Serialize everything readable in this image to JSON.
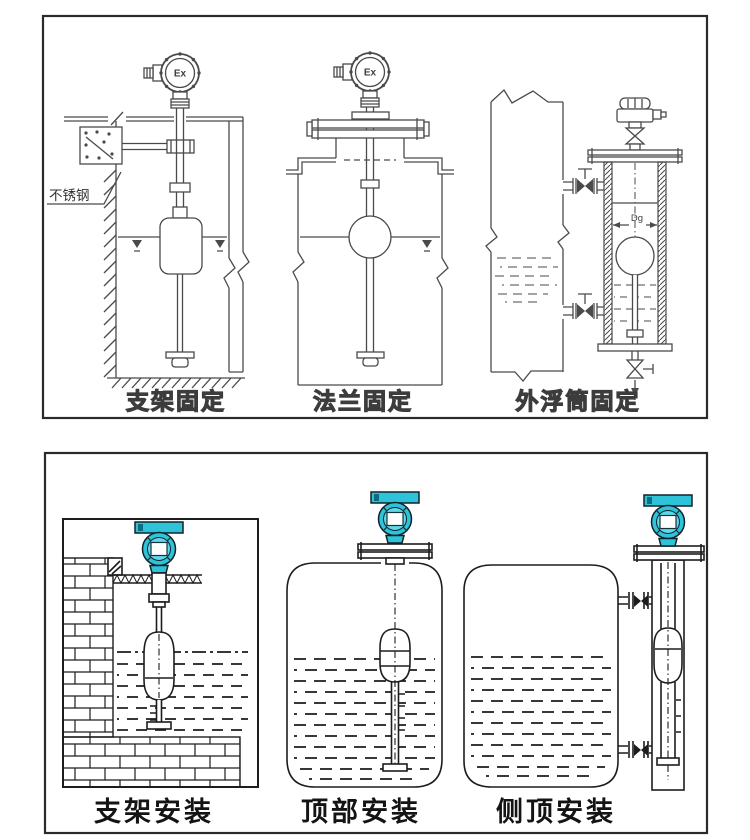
{
  "colors": {
    "background": "#ffffff",
    "panel_border": "#2a2a2a",
    "line": "#4a4a4a",
    "line_dark": "#1d1d1d",
    "teal": "#2fc3da",
    "teal_light": "#5cd9ea",
    "teal_dark": "#0a6e80"
  },
  "top_panel": {
    "figures": [
      {
        "label": "支架固定",
        "ex_label": "Ex",
        "material_note": "不锈钢"
      },
      {
        "label": "法兰固定",
        "ex_label": "Ex"
      },
      {
        "label": "外浮筒固定",
        "dimension_label": "Dg"
      }
    ]
  },
  "bottom_panel": {
    "figures": [
      {
        "label": "支架安装"
      },
      {
        "label": "顶部安装"
      },
      {
        "label": "侧顶安装"
      }
    ]
  }
}
